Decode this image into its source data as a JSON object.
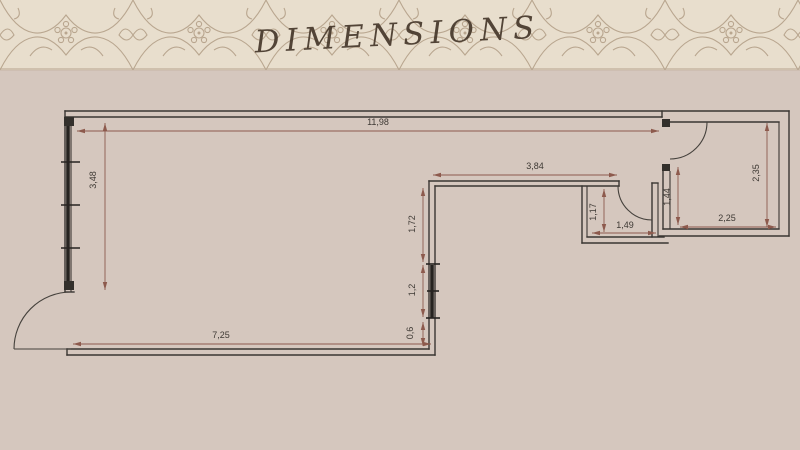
{
  "header": {
    "title": "DIMENSIONS"
  },
  "floorplan": {
    "colors": {
      "background": "#d5c7be",
      "band_base": "#e8decd",
      "band_pattern": "#b09c84",
      "wall": "#3a3632",
      "dimension": "#8d5a4d",
      "dimension_text": "#3e3934"
    },
    "dimensions": [
      {
        "label": "11,98",
        "o": "h",
        "x1": 77,
        "y1": 131,
        "x2": 659,
        "y2": 131,
        "lx": 378,
        "ly": 125
      },
      {
        "label": "3,48",
        "o": "v",
        "x1": 105,
        "y1": 123,
        "x2": 105,
        "y2": 290,
        "lx": 96,
        "ly": 180
      },
      {
        "label": "3,84",
        "o": "h",
        "x1": 433,
        "y1": 175,
        "x2": 617,
        "y2": 175,
        "lx": 535,
        "ly": 169
      },
      {
        "label": "1,72",
        "o": "v",
        "x1": 423,
        "y1": 188,
        "x2": 423,
        "y2": 262,
        "lx": 415,
        "ly": 224
      },
      {
        "label": "1,2",
        "o": "v",
        "x1": 423,
        "y1": 265,
        "x2": 423,
        "y2": 317,
        "lx": 415,
        "ly": 290
      },
      {
        "label": "0,6",
        "o": "v",
        "x1": 423,
        "y1": 322,
        "x2": 423,
        "y2": 346,
        "lx": 413,
        "ly": 333
      },
      {
        "label": "7,25",
        "o": "h",
        "x1": 73,
        "y1": 344,
        "x2": 431,
        "y2": 344,
        "lx": 221,
        "ly": 338
      },
      {
        "label": "1,49",
        "o": "h",
        "x1": 592,
        "y1": 233,
        "x2": 656,
        "y2": 233,
        "lx": 625,
        "ly": 228
      },
      {
        "label": "1,17",
        "o": "v",
        "x1": 604,
        "y1": 189,
        "x2": 604,
        "y2": 232,
        "lx": 596,
        "ly": 212
      },
      {
        "label": "1,44",
        "o": "v",
        "x1": 678,
        "y1": 167,
        "x2": 678,
        "y2": 225,
        "lx": 670,
        "ly": 197
      },
      {
        "label": "2,25",
        "o": "h",
        "x1": 680,
        "y1": 227,
        "x2": 776,
        "y2": 227,
        "lx": 727,
        "ly": 221
      },
      {
        "label": "2,35",
        "o": "v",
        "x1": 767,
        "y1": 123,
        "x2": 767,
        "y2": 227,
        "lx": 759,
        "ly": 173
      }
    ]
  }
}
